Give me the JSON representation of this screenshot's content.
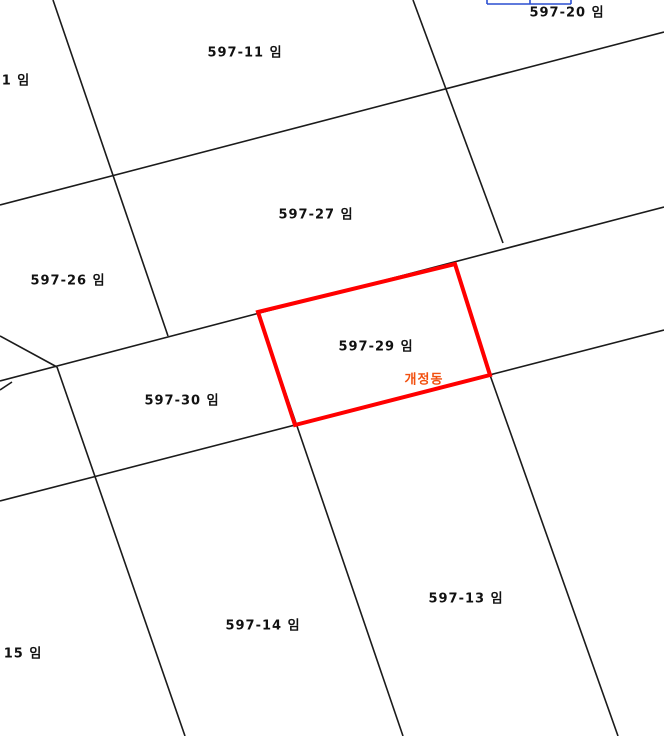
{
  "map": {
    "width": 664,
    "height": 736,
    "background": "#ffffff",
    "line_color": "#1b1b1b",
    "label_color": "#111111",
    "highlight": {
      "color": "#ff0000",
      "points": "258,312 455,264 490,375 295,425",
      "label": {
        "text": "597-29 임",
        "x": 376,
        "y": 345
      },
      "dong_label": {
        "text": "개정동",
        "x": 424,
        "y": 378,
        "color": "#f2500f"
      }
    },
    "clipped_blue_box": {
      "color": "#2a4fd0",
      "x1": 487,
      "x2": 571,
      "divider_x": 530,
      "y_bottom": 4
    },
    "parcel_labels": [
      {
        "text": "597-20 임",
        "x": 567,
        "y": 11
      },
      {
        "text": "597-11 임",
        "x": 245,
        "y": 51
      },
      {
        "text": "1 임",
        "x": 16,
        "y": 79
      },
      {
        "text": "597-27 임",
        "x": 316,
        "y": 213
      },
      {
        "text": "597-26 임",
        "x": 68,
        "y": 279
      },
      {
        "text": "597-30 임",
        "x": 182,
        "y": 399
      },
      {
        "text": "597-13 임",
        "x": 466,
        "y": 597
      },
      {
        "text": "597-14 임",
        "x": 263,
        "y": 624
      },
      {
        "text": "15 임",
        "x": 23,
        "y": 652
      }
    ],
    "boundary_lines": [
      {
        "x1": 53,
        "y1": 0,
        "x2": 168,
        "y2": 336
      },
      {
        "x1": 413,
        "y1": 0,
        "x2": 503,
        "y2": 243
      },
      {
        "x1": 0,
        "y1": 205,
        "x2": 664,
        "y2": 32
      },
      {
        "x1": 0,
        "y1": 381,
        "x2": 664,
        "y2": 207
      },
      {
        "x1": 0,
        "y1": 501,
        "x2": 664,
        "y2": 330
      },
      {
        "x1": 57,
        "y1": 367,
        "x2": 185,
        "y2": 736
      },
      {
        "x1": 258,
        "y1": 312,
        "x2": 403,
        "y2": 736
      },
      {
        "x1": 455,
        "y1": 264,
        "x2": 490,
        "y2": 375
      },
      {
        "x1": 490,
        "y1": 375,
        "x2": 618,
        "y2": 736
      },
      {
        "x1": 0,
        "y1": 336,
        "x2": 57,
        "y2": 367
      },
      {
        "x1": 0,
        "y1": 390,
        "x2": 12,
        "y2": 382
      }
    ]
  }
}
